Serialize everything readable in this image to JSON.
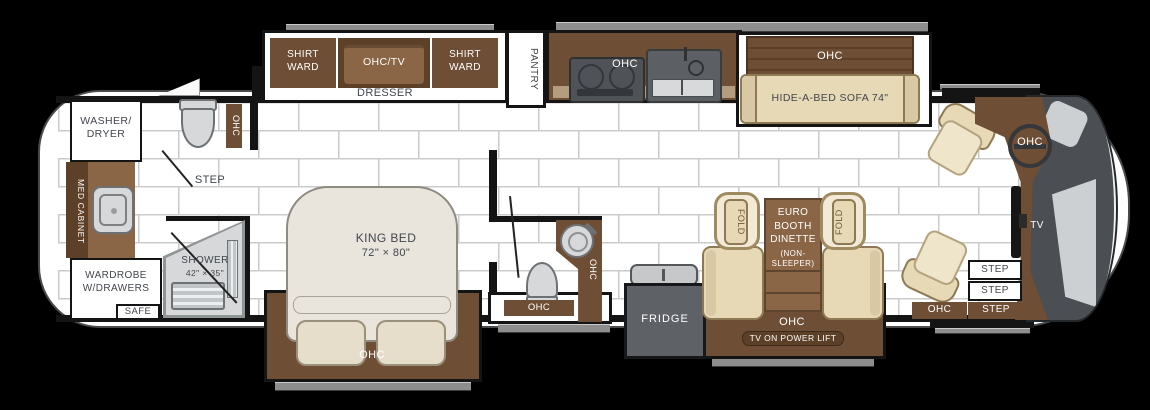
{
  "palette": {
    "wall": "#141414",
    "floor_line": "#cbcbcb",
    "brown": "#6e4e35",
    "brown_dark": "#5d4028",
    "brown_light": "#8a6647",
    "counter": "#b49c7e",
    "tan": "#e7d8b6",
    "tan_dark": "#d9c8a4",
    "cream": "#e9e5dc",
    "appliance": "#5e6166",
    "fixture": "#d6d8da",
    "fixture_border": "#6e7174",
    "windshield": "#4b4e52",
    "text": "#41464d"
  },
  "labels": {
    "ohc": "OHC",
    "ohc_tv": "OHC/TV",
    "shirt_ward": "SHIRT\nWARD",
    "dresser": "DRESSER",
    "pantry": "PANTRY",
    "hide_a_bed_sofa": "HIDE-A-BED SOFA 74\"",
    "washer_dryer": "WASHER/\nDRYER",
    "med_cabinet": "MED CABINET",
    "wardrobe": "WARDROBE\nW/DRAWERS",
    "safe": "SAFE",
    "step": "STEP",
    "shower": "SHOWER",
    "shower_size": "42\" × 35\"",
    "king_bed": "KING BED",
    "king_bed_size": "72\" × 80\"",
    "fridge": "FRIDGE",
    "fold": "FOLD",
    "dinette_title": "EURO\nBOOTH\nDINETTE",
    "dinette_sub": "(NON-\nSLEEPER)",
    "dinette_tv": "TV ON POWER LIFT",
    "tv": "TV"
  }
}
